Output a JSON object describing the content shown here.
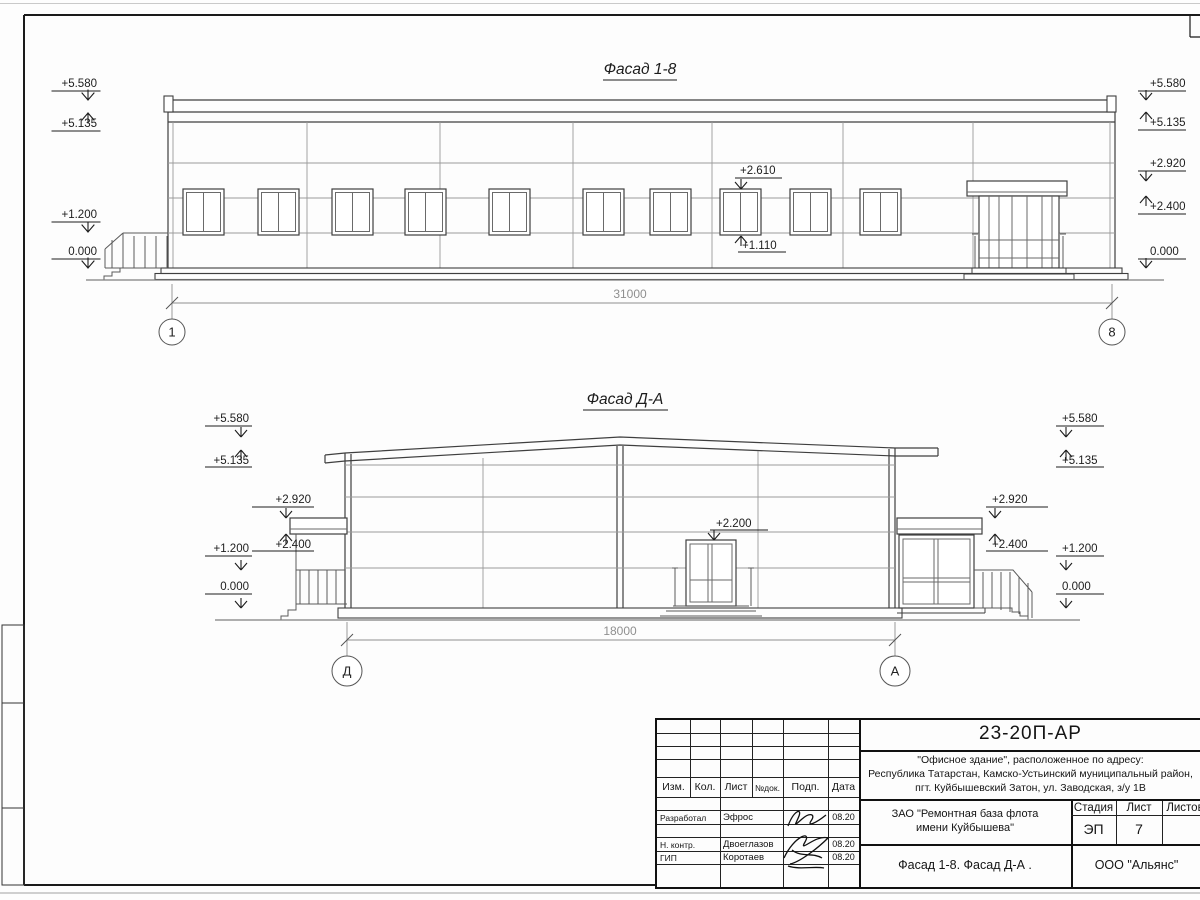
{
  "facade_top": {
    "title": "Фасад 1-8",
    "dim": "31000",
    "axis_left": "1",
    "axis_right": "8",
    "marks_left": [
      "+5.580",
      "+5.135",
      "+1.200",
      "0.000"
    ],
    "marks_right": [
      "+5.580",
      "+5.135",
      "+2.920",
      "+2.400",
      "0.000"
    ],
    "window_head": "+2.610",
    "window_sill": "+1.110"
  },
  "facade_bottom": {
    "title": "Фасад Д-А",
    "dim": "18000",
    "axis_left": "Д",
    "axis_right": "А",
    "marks_left": [
      "+5.580",
      "+5.135",
      "+2.920",
      "+2.400",
      "+1.200",
      "0.000"
    ],
    "marks_right": [
      "+5.580",
      "+5.135",
      "+2.920",
      "+2.400",
      "+1.200",
      "0.000"
    ],
    "door_head": "+2.200"
  },
  "titleblock": {
    "doc_code": "23-20П-АР",
    "object_line1": "\"Офисное здание\", расположенное по адресу:",
    "object_line2": "Республика Татарстан, Камско-Устьинский муниципальный район,",
    "object_line3": "пгт. Куйбышевский Затон, ул. Заводская, з/у 1В",
    "client_line1": "ЗАО \"Ремонтная база флота",
    "client_line2": "имени Куйбышева\"",
    "sheet_name": "Фасад 1-8. Фасад Д-А .",
    "org": "ООО \"Альянс\"",
    "stage_label": "Стадия",
    "list_label": "Лист",
    "lists_label": "Листов",
    "stage_value": "ЭП",
    "list_value": "7",
    "cols": {
      "izm": "Изм.",
      "kol": "Кол.",
      "list": "Лист",
      "doc": "№док.",
      "podp": "Подп.",
      "data": "Дата"
    },
    "rows": [
      {
        "role": "Разработал",
        "name": "Эфрос",
        "date": "08.20"
      },
      {
        "role": "Н. контр.",
        "name": "Двоеглазов",
        "date": "08.20"
      },
      {
        "role": "ГИП",
        "name": "Коротаев",
        "date": "08.20"
      }
    ]
  }
}
